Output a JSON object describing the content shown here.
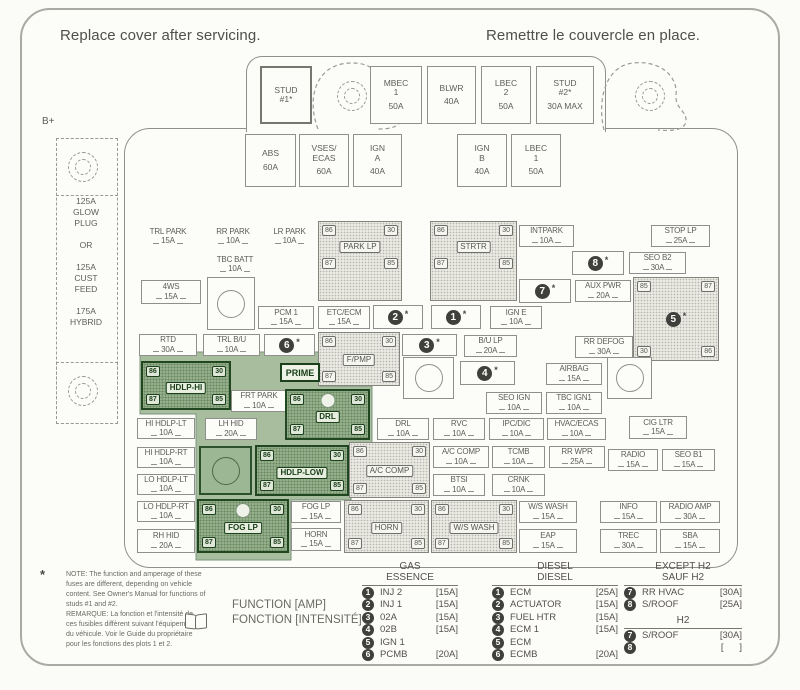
{
  "page": {
    "title_left": "Replace cover after servicing.",
    "title_right": "Remettre le couvercle en place.",
    "b_plus": "B+"
  },
  "left_block": {
    "text": "125A\nGLOW\nPLUG\n\nOR\n\n125A\nCUST\nFEED\n\n175A\nHYBRID"
  },
  "prime": {
    "label": "PRIME"
  },
  "top_fuses": [
    {
      "label": "STUD\n#1*",
      "amp": "",
      "x": 260,
      "y": 66,
      "w": 52,
      "h": 58,
      "thick": true
    },
    {
      "label": "MBEC\n1",
      "amp": "50A",
      "x": 370,
      "y": 66,
      "w": 52,
      "h": 58
    },
    {
      "label": "BLWR",
      "amp": "40A",
      "x": 427,
      "y": 66,
      "w": 49,
      "h": 58
    },
    {
      "label": "LBEC\n2",
      "amp": "50A",
      "x": 481,
      "y": 66,
      "w": 50,
      "h": 58
    },
    {
      "label": "STUD\n#2*",
      "amp": "30A MAX",
      "x": 536,
      "y": 66,
      "w": 58,
      "h": 58
    },
    {
      "label": "ABS",
      "amp": "60A",
      "x": 245,
      "y": 134,
      "w": 51,
      "h": 53
    },
    {
      "label": "VSES/\nECAS",
      "amp": "60A",
      "x": 299,
      "y": 134,
      "w": 50,
      "h": 53
    },
    {
      "label": "IGN\nA",
      "amp": "40A",
      "x": 353,
      "y": 134,
      "w": 49,
      "h": 53
    },
    {
      "label": "IGN\nB",
      "amp": "40A",
      "x": 457,
      "y": 134,
      "w": 50,
      "h": 53
    },
    {
      "label": "LBEC\n1",
      "amp": "50A",
      "x": 511,
      "y": 134,
      "w": 50,
      "h": 53
    }
  ],
  "fuses": [
    {
      "label": "TRL PARK",
      "amp": "15A",
      "x": 138,
      "y": 226,
      "w": 60,
      "h": 21,
      "plain": true
    },
    {
      "label": "RR PARK",
      "amp": "10A",
      "x": 203,
      "y": 226,
      "w": 60,
      "h": 21,
      "plain": true
    },
    {
      "label": "LR PARK",
      "amp": "10A",
      "x": 261,
      "y": 226,
      "w": 57,
      "h": 21,
      "plain": true
    },
    {
      "label": "TBC BATT",
      "amp": "10A",
      "x": 203,
      "y": 254,
      "w": 64,
      "h": 21,
      "plain": true
    },
    {
      "label": "INTPARK",
      "amp": "10A",
      "x": 519,
      "y": 225,
      "w": 55,
      "h": 22
    },
    {
      "label": "STOP LP",
      "amp": "25A",
      "x": 651,
      "y": 225,
      "w": 59,
      "h": 22
    },
    {
      "label": "SEO B2",
      "amp": "30A",
      "x": 629,
      "y": 252,
      "w": 57,
      "h": 22
    },
    {
      "label": "AUX PWR",
      "amp": "20A",
      "x": 575,
      "y": 280,
      "w": 56,
      "h": 22
    },
    {
      "label": "4WS",
      "amp": "15A",
      "x": 141,
      "y": 280,
      "w": 60,
      "h": 24
    },
    {
      "label": "PCM 1",
      "amp": "15A",
      "x": 258,
      "y": 306,
      "w": 56,
      "h": 23
    },
    {
      "label": "ETC/ECM",
      "amp": "15A",
      "x": 318,
      "y": 306,
      "w": 52,
      "h": 23
    },
    {
      "label": "IGN E",
      "amp": "10A",
      "x": 490,
      "y": 306,
      "w": 52,
      "h": 23
    },
    {
      "label": "RTD",
      "amp": "30A",
      "x": 139,
      "y": 334,
      "w": 58,
      "h": 22
    },
    {
      "label": "TRL B/U",
      "amp": "10A",
      "x": 203,
      "y": 334,
      "w": 57,
      "h": 22
    },
    {
      "label": "B/U LP",
      "amp": "20A",
      "x": 464,
      "y": 335,
      "w": 53,
      "h": 22
    },
    {
      "label": "RR DEFOG",
      "amp": "30A",
      "x": 575,
      "y": 336,
      "w": 58,
      "h": 22
    },
    {
      "label": "AIRBAG",
      "amp": "15A",
      "x": 546,
      "y": 363,
      "w": 56,
      "h": 22
    },
    {
      "label": "SEO IGN",
      "amp": "10A",
      "x": 486,
      "y": 392,
      "w": 56,
      "h": 22
    },
    {
      "label": "TBC IGN1",
      "amp": "10A",
      "x": 546,
      "y": 392,
      "w": 56,
      "h": 22
    },
    {
      "label": "FRT PARK",
      "amp": "10A",
      "x": 231,
      "y": 390,
      "w": 56,
      "h": 22
    },
    {
      "label": "LH HID",
      "amp": "20A",
      "x": 205,
      "y": 418,
      "w": 52,
      "h": 22
    },
    {
      "label": "HI HDLP-LT",
      "amp": "10A",
      "x": 137,
      "y": 418,
      "w": 58,
      "h": 21
    },
    {
      "label": "DRL",
      "amp": "10A",
      "x": 377,
      "y": 418,
      "w": 52,
      "h": 22
    },
    {
      "label": "RVC",
      "amp": "10A",
      "x": 433,
      "y": 418,
      "w": 52,
      "h": 22
    },
    {
      "label": "IPC/DIC",
      "amp": "10A",
      "x": 489,
      "y": 418,
      "w": 55,
      "h": 22
    },
    {
      "label": "HVAC/ECAS",
      "amp": "10A",
      "x": 547,
      "y": 418,
      "w": 59,
      "h": 22
    },
    {
      "label": "CIG LTR",
      "amp": "15A",
      "x": 629,
      "y": 416,
      "w": 58,
      "h": 23
    },
    {
      "label": "HI HDLP-RT",
      "amp": "10A",
      "x": 137,
      "y": 447,
      "w": 58,
      "h": 21
    },
    {
      "label": "A/C COMP",
      "amp": "10A",
      "x": 433,
      "y": 446,
      "w": 56,
      "h": 22
    },
    {
      "label": "TCMB",
      "amp": "10A",
      "x": 492,
      "y": 446,
      "w": 53,
      "h": 22
    },
    {
      "label": "RR WPR",
      "amp": "25A",
      "x": 549,
      "y": 446,
      "w": 56,
      "h": 22
    },
    {
      "label": "RADIO",
      "amp": "15A",
      "x": 608,
      "y": 449,
      "w": 50,
      "h": 22
    },
    {
      "label": "SEO B1",
      "amp": "15A",
      "x": 662,
      "y": 449,
      "w": 53,
      "h": 22
    },
    {
      "label": "LO HDLP-LT",
      "amp": "10A",
      "x": 137,
      "y": 474,
      "w": 58,
      "h": 21
    },
    {
      "label": "BTSI",
      "amp": "10A",
      "x": 433,
      "y": 474,
      "w": 52,
      "h": 22
    },
    {
      "label": "CRNK",
      "amp": "10A",
      "x": 492,
      "y": 474,
      "w": 53,
      "h": 22
    },
    {
      "label": "LO HDLP-RT",
      "amp": "10A",
      "x": 137,
      "y": 501,
      "w": 58,
      "h": 21
    },
    {
      "label": "FOG LP",
      "amp": "15A",
      "x": 291,
      "y": 501,
      "w": 50,
      "h": 22
    },
    {
      "label": "HORN",
      "amp": "15A",
      "x": 291,
      "y": 528,
      "w": 50,
      "h": 23
    },
    {
      "label": "RH HID",
      "amp": "20A",
      "x": 137,
      "y": 529,
      "w": 58,
      "h": 24
    },
    {
      "label": "W/S WASH",
      "amp": "15A",
      "x": 519,
      "y": 501,
      "w": 58,
      "h": 22
    },
    {
      "label": "EAP",
      "amp": "15A",
      "x": 519,
      "y": 529,
      "w": 58,
      "h": 24
    },
    {
      "label": "INFO",
      "amp": "15A",
      "x": 600,
      "y": 501,
      "w": 57,
      "h": 22
    },
    {
      "label": "RADIO AMP",
      "amp": "30A",
      "x": 660,
      "y": 501,
      "w": 60,
      "h": 22
    },
    {
      "label": "TREC",
      "amp": "30A",
      "x": 600,
      "y": 529,
      "w": 57,
      "h": 24
    },
    {
      "label": "SBA",
      "amp": "15A",
      "x": 660,
      "y": 529,
      "w": 60,
      "h": 24
    }
  ],
  "relays": [
    {
      "name": "PARK LP",
      "x": 318,
      "y": 221,
      "w": 84,
      "h": 80,
      "apron": true,
      "pins": [
        "86",
        "30",
        "87",
        "85"
      ]
    },
    {
      "name": "STRTR",
      "x": 430,
      "y": 221,
      "w": 87,
      "h": 80,
      "apron": true,
      "pins": [
        "86",
        "30",
        "87",
        "85"
      ]
    },
    {
      "name": "F/PMP",
      "x": 318,
      "y": 332,
      "w": 82,
      "h": 54,
      "pins": [
        "86",
        "30",
        "87",
        "85"
      ]
    },
    {
      "name": "A/C COMP",
      "x": 349,
      "y": 442,
      "w": 81,
      "h": 56,
      "pins": [
        "86",
        "30",
        "87",
        "85"
      ]
    },
    {
      "name": "HORN",
      "x": 344,
      "y": 500,
      "w": 85,
      "h": 53,
      "pins": [
        "86",
        "30",
        "87",
        "85"
      ]
    },
    {
      "name": "W/S WASH",
      "x": 431,
      "y": 500,
      "w": 86,
      "h": 53,
      "pins": [
        "86",
        "30",
        "87",
        "85"
      ]
    },
    {
      "name": "HDLP-HI",
      "x": 141,
      "y": 361,
      "w": 90,
      "h": 49,
      "green": true,
      "pins": [
        "86",
        "30",
        "87",
        "85"
      ]
    },
    {
      "name": "DRL",
      "x": 285,
      "y": 389,
      "w": 85,
      "h": 51,
      "green": true,
      "hole": true,
      "pins": [
        "86",
        "30",
        "87",
        "85"
      ]
    },
    {
      "name": "HDLP-LOW",
      "x": 255,
      "y": 445,
      "w": 94,
      "h": 51,
      "green": true,
      "pins": [
        "86",
        "30",
        "87",
        "85"
      ]
    },
    {
      "name": "FOG LP",
      "x": 197,
      "y": 499,
      "w": 92,
      "h": 54,
      "green": true,
      "hole": true,
      "pins": [
        "86",
        "30",
        "87",
        "85"
      ]
    }
  ],
  "big_relay": {
    "num": "5",
    "ast": "*",
    "x": 633,
    "y": 277,
    "w": 86,
    "h": 84,
    "pins": [
      "85",
      "87",
      "30",
      "86"
    ]
  },
  "num_boxes": [
    {
      "num": "1",
      "ast": "*",
      "x": 431,
      "y": 305,
      "w": 50,
      "h": 24
    },
    {
      "num": "2",
      "ast": "*",
      "x": 373,
      "y": 305,
      "w": 50,
      "h": 24
    },
    {
      "num": "3",
      "ast": "*",
      "x": 402,
      "y": 334,
      "w": 55,
      "h": 22
    },
    {
      "num": "4",
      "ast": "*",
      "x": 460,
      "y": 361,
      "w": 55,
      "h": 24
    },
    {
      "num": "6",
      "ast": "*",
      "x": 264,
      "y": 334,
      "w": 51,
      "h": 22
    },
    {
      "num": "7",
      "ast": "*",
      "x": 519,
      "y": 279,
      "w": 52,
      "h": 24
    },
    {
      "num": "8",
      "ast": "*",
      "x": 572,
      "y": 251,
      "w": 52,
      "h": 24
    }
  ],
  "circle_boxes": [
    {
      "x": 207,
      "y": 277,
      "w": 48,
      "h": 53
    },
    {
      "x": 403,
      "y": 357,
      "w": 51,
      "h": 42
    },
    {
      "x": 607,
      "y": 357,
      "w": 45,
      "h": 42
    },
    {
      "x": 199,
      "y": 446,
      "w": 53,
      "h": 49,
      "green": true
    }
  ],
  "legend": {
    "function_lines": "FUNCTION [AMP]\nFONCTION [INTENSITÉ]",
    "columns": [
      {
        "id": "gas",
        "x": 362,
        "w": 96,
        "header": "GAS\nESSENCE",
        "items": [
          {
            "num": "1",
            "name": "INJ 2",
            "amp": "[15A]"
          },
          {
            "num": "2",
            "name": "INJ 1",
            "amp": "[15A]"
          },
          {
            "num": "3",
            "name": "02A",
            "amp": "[15A]"
          },
          {
            "num": "4",
            "name": "02B",
            "amp": "[15A]"
          },
          {
            "num": "5",
            "name": "IGN 1",
            "amp": ""
          },
          {
            "num": "6",
            "name": "PCMB",
            "amp": "[20A]"
          }
        ]
      },
      {
        "id": "diesel",
        "x": 492,
        "w": 126,
        "header": "DIESEL\nDIESEL",
        "items": [
          {
            "num": "1",
            "name": "ECM",
            "amp": "[25A]"
          },
          {
            "num": "2",
            "name": "ACTUATOR",
            "amp": "[15A]"
          },
          {
            "num": "3",
            "name": "FUEL HTR",
            "amp": "[15A]"
          },
          {
            "num": "4",
            "name": "ECM 1",
            "amp": "[15A]"
          },
          {
            "num": "5",
            "name": "ECM",
            "amp": ""
          },
          {
            "num": "6",
            "name": "ECMB",
            "amp": "[20A]"
          }
        ]
      },
      {
        "id": "except-h2",
        "x": 624,
        "w": 118,
        "header": "EXCEPT H2\nSAUF H2",
        "items": [
          {
            "num": "7",
            "name": "RR HVAC",
            "amp": "[30A]"
          },
          {
            "num": "8",
            "name": "S/ROOF",
            "amp": "[25A]"
          }
        ],
        "sub": {
          "header": "H2",
          "items": [
            {
              "num": "7",
              "name": "S/ROOF",
              "amp": "[30A]"
            },
            {
              "num": "8",
              "name": "",
              "amp": "[      ]"
            }
          ]
        }
      }
    ]
  },
  "notes": {
    "star": "*",
    "en": "NOTE:  The function and amperage of these fuses are different, depending on vehicle content. See Owner's Manual for functions of studs #1 and #2.",
    "fr": "REMARQUE: La fonction et l'intensité de ces fusibles diffèrent suivant l'équipement du véhicule. Voir le Guide du propriétaire pour les fonctions des plots 1 et 2."
  },
  "colors": {
    "green_area": "#a7bd9e",
    "green_dark": "#20471f",
    "line_gray": "#8f8f8b",
    "text_gray": "#5d5d58"
  }
}
